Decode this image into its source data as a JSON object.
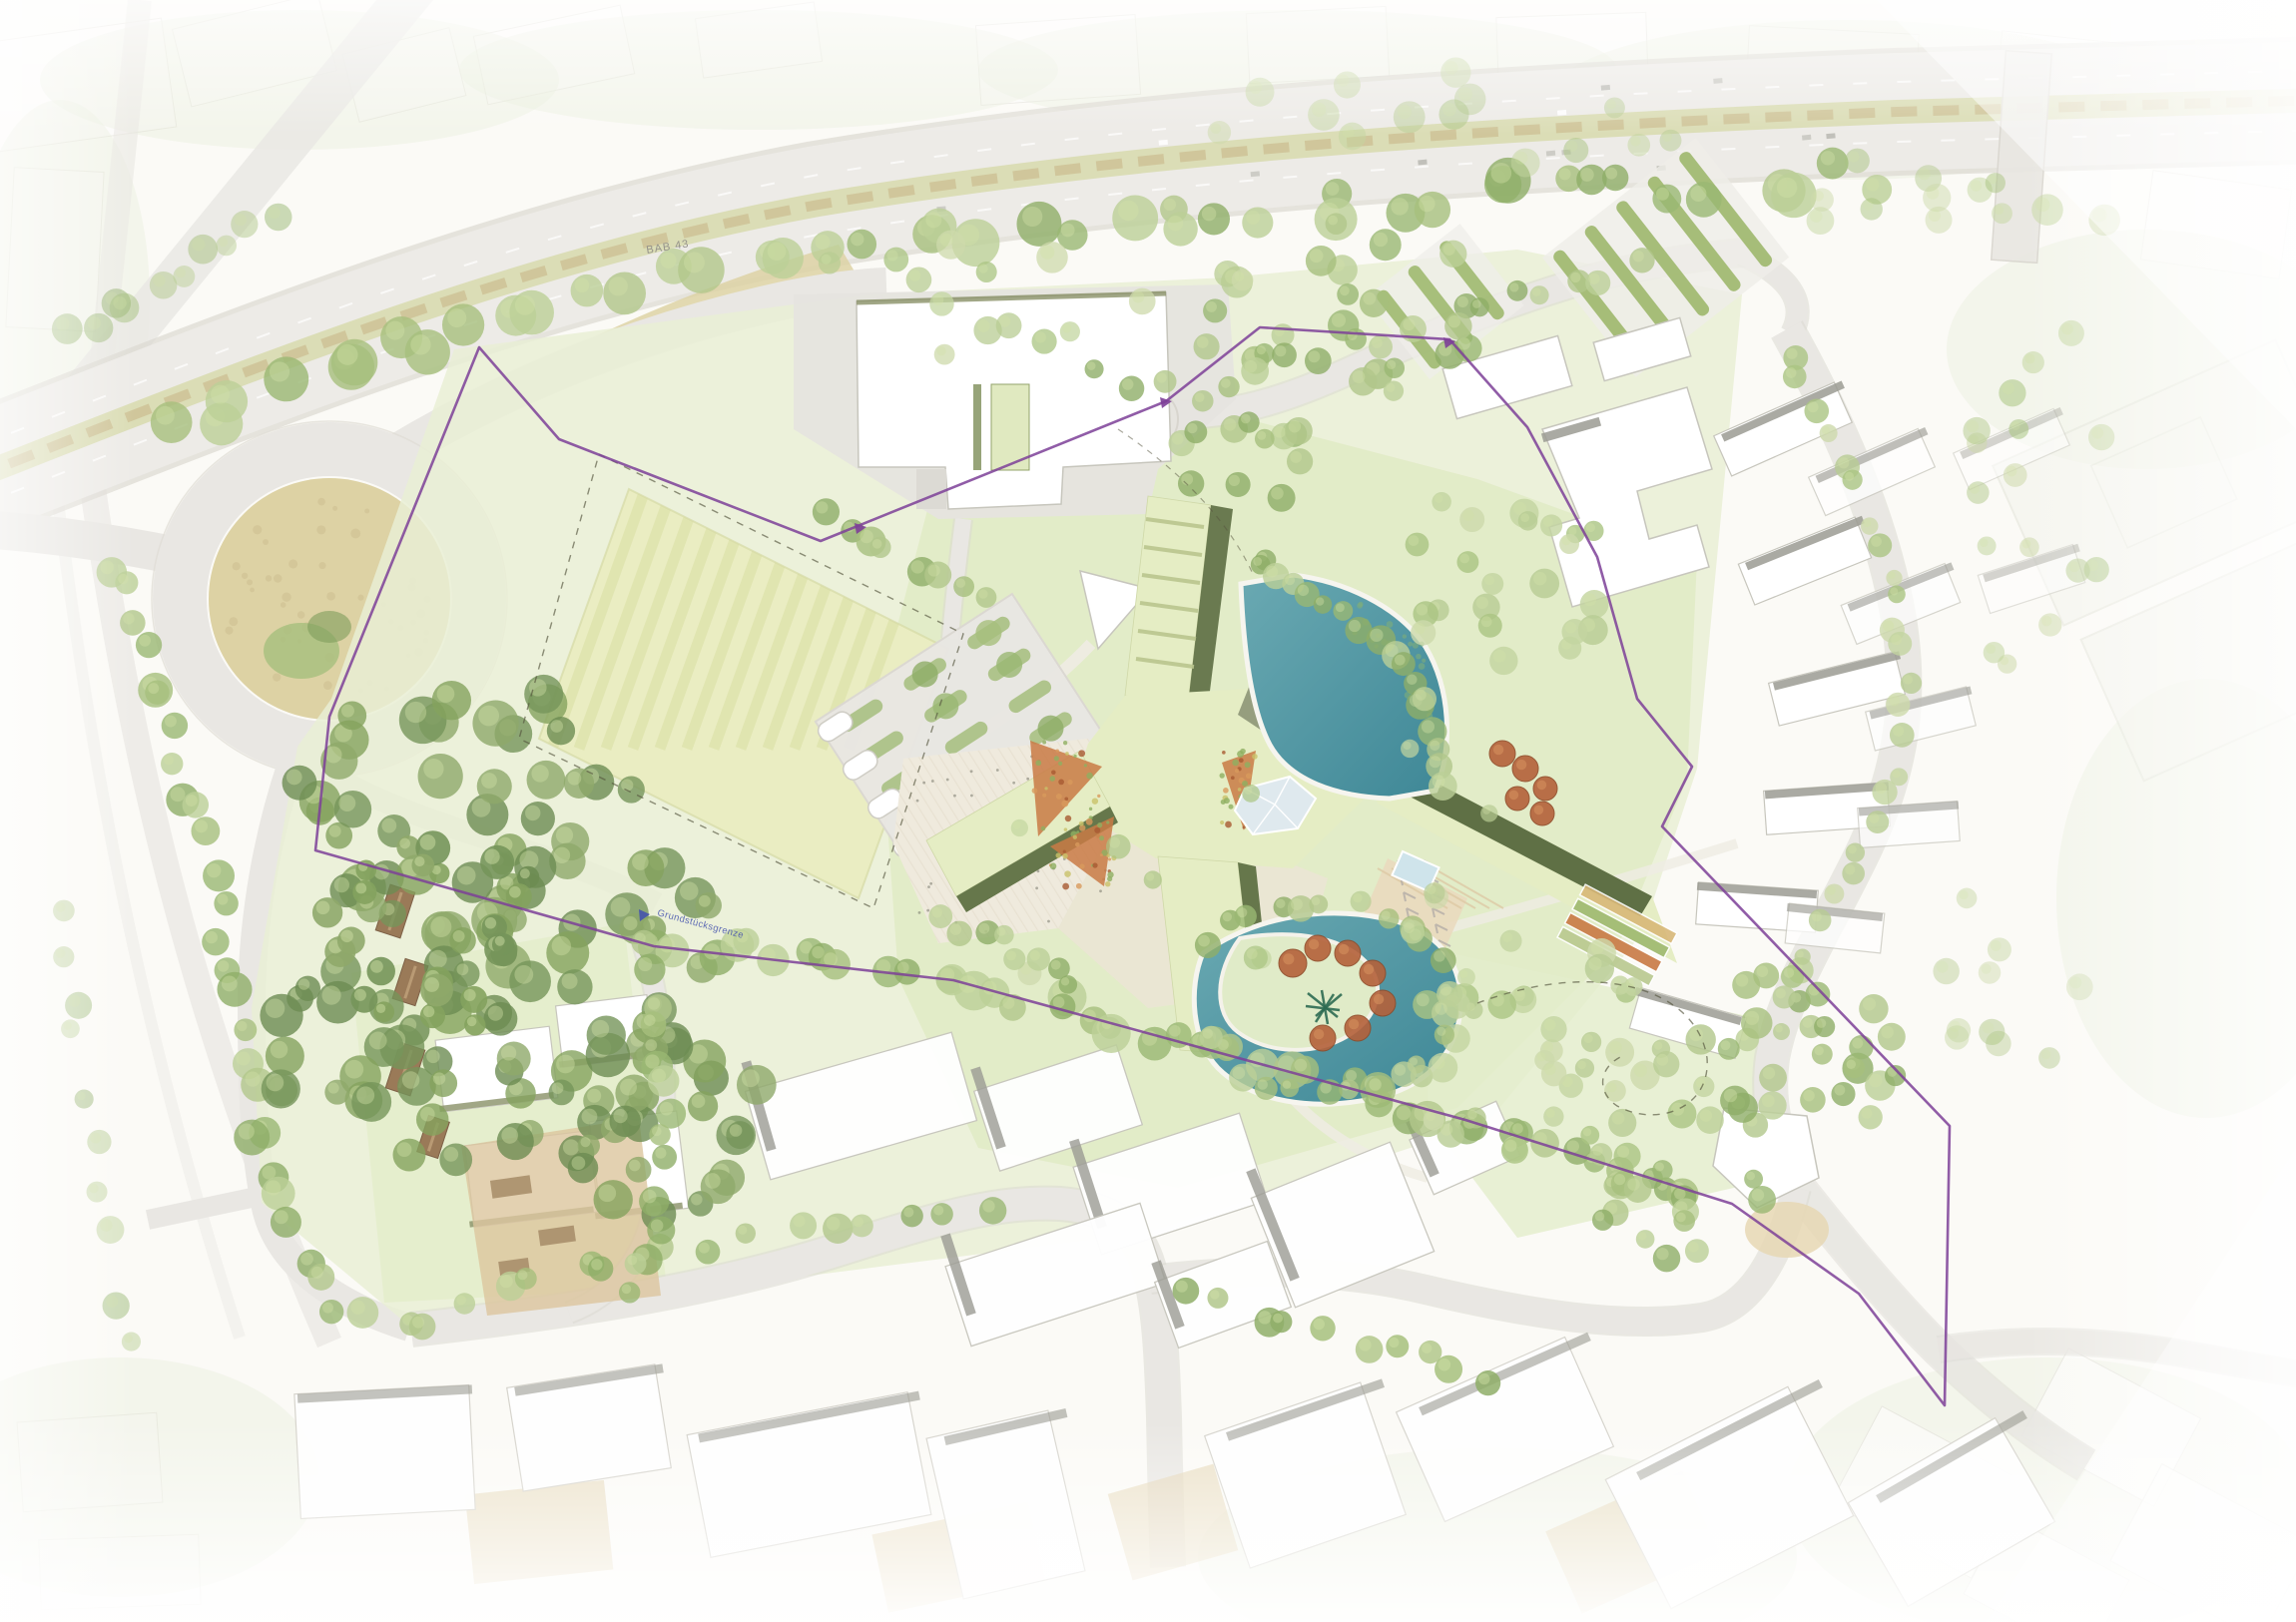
{
  "labels": {
    "highway": "BAB 43",
    "boundary": "Grundstücksgrenze"
  },
  "palette": {
    "background": "#fbfaf6",
    "road": "#e9e7e3",
    "road_edge": "#dbd8d2",
    "highway_median_green": "#d8dcb0",
    "highway_median_tan": "#ccbd92",
    "field_tan": "#ddd2a4",
    "lawn": "#e9efd5",
    "lawn_bright": "#e1ebc5",
    "meadow": "#eaedc2",
    "meadow_stripe": "#dfe3ae",
    "hedge": "#9fb96f",
    "canopy_green": "#a6bf7d",
    "canopy_dark": "#7f9c5c",
    "canopy_light": "#bccf97",
    "canopy_autumn": "#b4613a",
    "water": "#4f98a4",
    "water_deep": "#3e8796",
    "building_white": "#ffffff",
    "building_outline": "#c7c6bd",
    "roof_gray": "#9b9b93",
    "roof_green_pale": "#e5edc4",
    "roof_olive": "#5f7045",
    "roof_gray_green": "#8d9577",
    "plaza": "#f0ebdf",
    "sand": "#e6d7b4",
    "flowerbed": "#c97a45",
    "house_brown": "#9a7a58",
    "boundary_purple": "#7d3f98",
    "parcel_dash": "#55543e",
    "label_gray": "#95928a",
    "label_blue": "#4553ae"
  },
  "features": {
    "list": [
      "motorway-bab43",
      "roundabout-interchange",
      "striped-meadow-field",
      "existing-hall-building",
      "campus-x-building",
      "upper-pond",
      "lower-pond",
      "central-plaza",
      "parking-grove",
      "allotment-hedges",
      "east-residential-blocks",
      "southwest-buildings",
      "south-industrial-buildings",
      "bottom-industrial-area",
      "woodland",
      "site-boundary"
    ]
  }
}
